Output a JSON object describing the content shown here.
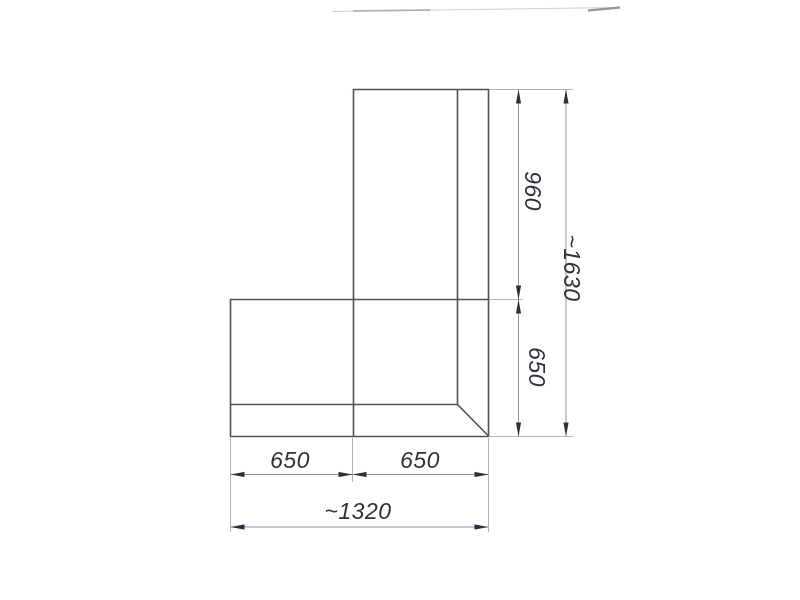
{
  "page": {
    "description": "Scanned technical drawing (plan view) of an L-shaped corner unit with dimension lines"
  },
  "drawing": {
    "colors": {
      "outline": "#4a505c",
      "dimension_line": "#8e939b",
      "extension_line": "#aeb2b9",
      "arrow": "#2b303b",
      "text": "#2d323b"
    },
    "outline_lines": [
      [
        353,
        89.5,
        489,
        89.5
      ],
      [
        353.5,
        89,
        353.5,
        436.5
      ],
      [
        457.5,
        89,
        457.5,
        404.5
      ],
      [
        488.5,
        89,
        488.5,
        436.5
      ],
      [
        230,
        299.5,
        489,
        299.5
      ],
      [
        230.5,
        299,
        230.5,
        436.5
      ],
      [
        230,
        404.5,
        457.5,
        404.5
      ],
      [
        230,
        436.5,
        488.5,
        436.5
      ],
      [
        457.5,
        404.5,
        489,
        436.5
      ]
    ],
    "extension_lines": [
      [
        489,
        89.5,
        573,
        89.5
      ],
      [
        489,
        299.5,
        523,
        299.5
      ],
      [
        489,
        436.5,
        573,
        436.5
      ],
      [
        230.5,
        438,
        230.5,
        532
      ],
      [
        352.5,
        438,
        352.5,
        482
      ],
      [
        488.5,
        438,
        488.5,
        532
      ]
    ],
    "dimension_lines": [
      [
        518.5,
        90,
        518.5,
        436
      ],
      [
        566,
        90,
        566,
        436
      ],
      [
        231,
        474.5,
        488,
        474.5
      ],
      [
        231,
        527,
        488,
        527
      ]
    ],
    "arrows": [
      {
        "x": 518.5,
        "y": 89.5,
        "dir": "up"
      },
      {
        "x": 518.5,
        "y": 299.5,
        "dir": "down"
      },
      {
        "x": 518.5,
        "y": 299.5,
        "dir": "up"
      },
      {
        "x": 518.5,
        "y": 436.5,
        "dir": "down"
      },
      {
        "x": 566,
        "y": 89.5,
        "dir": "up"
      },
      {
        "x": 566,
        "y": 436.5,
        "dir": "down"
      },
      {
        "x": 230.5,
        "y": 474.5,
        "dir": "left"
      },
      {
        "x": 352.5,
        "y": 474.5,
        "dir": "right"
      },
      {
        "x": 352.5,
        "y": 474.5,
        "dir": "left"
      },
      {
        "x": 488.5,
        "y": 474.5,
        "dir": "right"
      },
      {
        "x": 230.5,
        "y": 527,
        "dir": "left"
      },
      {
        "x": 488.5,
        "y": 527,
        "dir": "right"
      }
    ],
    "labels": [
      {
        "text": "960",
        "x": 525,
        "y": 191,
        "rotate": 90,
        "name": "dim-label-960"
      },
      {
        "text": "650",
        "x": 529,
        "y": 367,
        "rotate": 90,
        "name": "dim-label-650-vertical"
      },
      {
        "text": "~1630",
        "x": 564,
        "y": 268,
        "rotate": 90,
        "name": "dim-label-1630-overall-height"
      },
      {
        "text": "650",
        "x": 290,
        "y": 468,
        "rotate": 0,
        "name": "dim-label-650-left"
      },
      {
        "text": "650",
        "x": 420,
        "y": 468,
        "rotate": 0,
        "name": "dim-label-650-right"
      },
      {
        "text": "~1320",
        "x": 358,
        "y": 519,
        "rotate": 0,
        "name": "dim-label-1320-overall-width"
      }
    ],
    "artifacts": [
      {
        "x1": 332,
        "y1": 11.5,
        "x2": 618,
        "y2": 7.5,
        "w": 1,
        "c": "#cdced2"
      },
      {
        "x1": 353,
        "y1": 11,
        "x2": 430,
        "y2": 10,
        "w": 1.8,
        "c": "#b0b1b7"
      },
      {
        "x1": 588,
        "y1": 10.5,
        "x2": 620,
        "y2": 7.5,
        "w": 2.2,
        "c": "#95969d"
      }
    ],
    "dimension_values": {
      "vertical_segments": [
        "960",
        "650"
      ],
      "vertical_overall": "~1630",
      "horizontal_segments": [
        "650",
        "650"
      ],
      "horizontal_overall": "~1320"
    }
  }
}
